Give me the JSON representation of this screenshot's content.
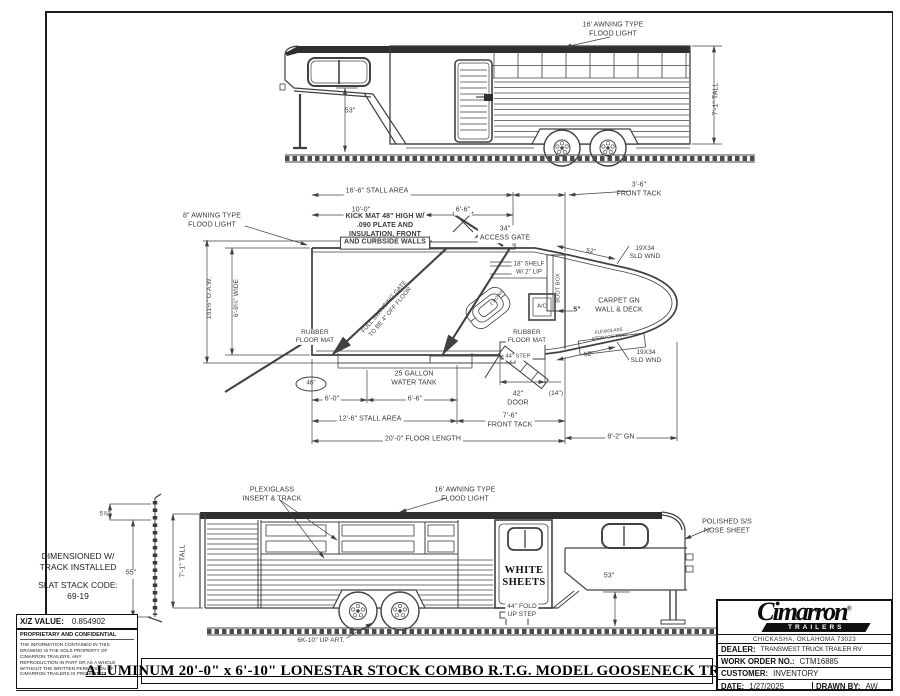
{
  "sheet": {
    "title": "ALUMINUM 20'-0\" x 6'-10\" LONESTAR STOCK COMBO R.T.G. MODEL GOOSENECK TRAILER"
  },
  "colors": {
    "line": "#414141",
    "ink": "#111111",
    "roof": "#2f2f2f"
  },
  "top_view": {
    "awning_light": "16' AWNING TYPE\nFLOOD LIGHT",
    "tall": "7'-1\" TALL",
    "gn_clearance": "53\""
  },
  "plan_view": {
    "stall_area": "16'-6\" STALL AREA",
    "front_tack_top": "3'-6\"\nFRONT TACK",
    "dim_10_0": "10'-0\"",
    "dim_6_6_top": "6'-6\"",
    "kick_mat_1": "KICK MAT 48\" HIGH W/\n.090 PLATE AND\nINSULATION, FRONT",
    "kick_mat_2": "AND CURBSIDE WALLS",
    "awning_light": "8\" AWNING TYPE\nFLOOD LIGHT",
    "access_gate": "34\"\nACCESS GATE",
    "shelf": "18\" SHELF\nW/ 2\" LIP",
    "boot_box": "BOOT BOX",
    "ac_unit": "A/C",
    "dim_5": "5\"",
    "dim_52_top": "52\"",
    "sld_wnd_top": "19X34\nSLD WND",
    "carpet_gn": "CARPET GN\nWALL & DECK",
    "flexiglass_tray": "FLEXIGLASS\nSTORAGE TRAY",
    "oaw": "101½\" O.A.W.",
    "wide": "6'-9¼\" WIDE",
    "rubber_mat_rear": "RUBBER\nFLOOR MAT",
    "rubber_mat_front": "RUBBER\nFLOOR MAT",
    "swing_gate": "FULL SWINGING GATE\nTO BE 4\" OFF FLOOR",
    "rows": "2 ROWS",
    "dim_46": "46\"",
    "water_tank": "25 GALLON\nWATER TANK",
    "dim_6_0": "6'-0\"",
    "dim_6_6_bot": "6'-6\"",
    "step_44": "44\" STEP",
    "door_42": "42\"\nDOOR",
    "dim_14": "(14\")",
    "dim_52_bot": "52\"",
    "sld_wnd_bot": "19X34\nSLD WND",
    "stall_area_bot": "12'-6\" STALL AREA",
    "front_tack_bot": "7'-6\"\nFRONT TACK",
    "floor_length": "20'-0\" FLOOR LENGTH",
    "gn_length": "8'-2\" GN"
  },
  "bottom_view": {
    "plexiglass": "PLEXIGLASS\nINSERT & TRACK",
    "awning_light": "16' AWNING TYPE\nFLOOD LIGHT",
    "nose_sheet": "POLISHED S/S\nNOSE SHEET",
    "tall": "7'-1\" TALL",
    "slat_55": "55\"",
    "slat_5_78": "5⅞\"",
    "white_sheets": "WHITE\nSHEETS",
    "fold_step": "44\" FOLD\nUP STEP",
    "gn_clearance": "53\"",
    "axle": "6K-10\" UP ART."
  },
  "notes": {
    "dimensioned": "DIMENSIONED W/\nTRACK INSTALLED",
    "slat_code": "SLAT STACK CODE:\n69-19",
    "xz_label": "X/Z VALUE:",
    "xz_value": "0.854902",
    "confidential_title": "PROPRIETARY AND CONFIDENTIAL",
    "confidential_body": "THE INFORMATION CONTAINED I​N THIS\nDRAWING IS THE SOLE PROPERTY OF\nCIMARRON TRAILERS.  ANY\nREPRODUCTION IN PART OR AS A WHOLE\nWITHOUT THE WRITTEN PERMISSION OF\nCIMARRON TRAILERS IS PROHIBITED."
  },
  "title_block": {
    "brand": "Cimarron",
    "reg": "®",
    "brand_sub": "TRAILERS",
    "address": "CHICKASHA, OKLAHOMA 73023",
    "dealer_label": "DEALER:",
    "dealer": "TRANSWEST TRUCK TRAILER RV",
    "wo_label": "WORK ORDER NO.:",
    "wo": "CTM16885",
    "customer_label": "CUSTOMER:",
    "customer": "INVENTORY",
    "date_label": "DATE:",
    "date": "1/27/2025",
    "drawn_label": "DRAWN BY:",
    "drawn": "AW"
  }
}
